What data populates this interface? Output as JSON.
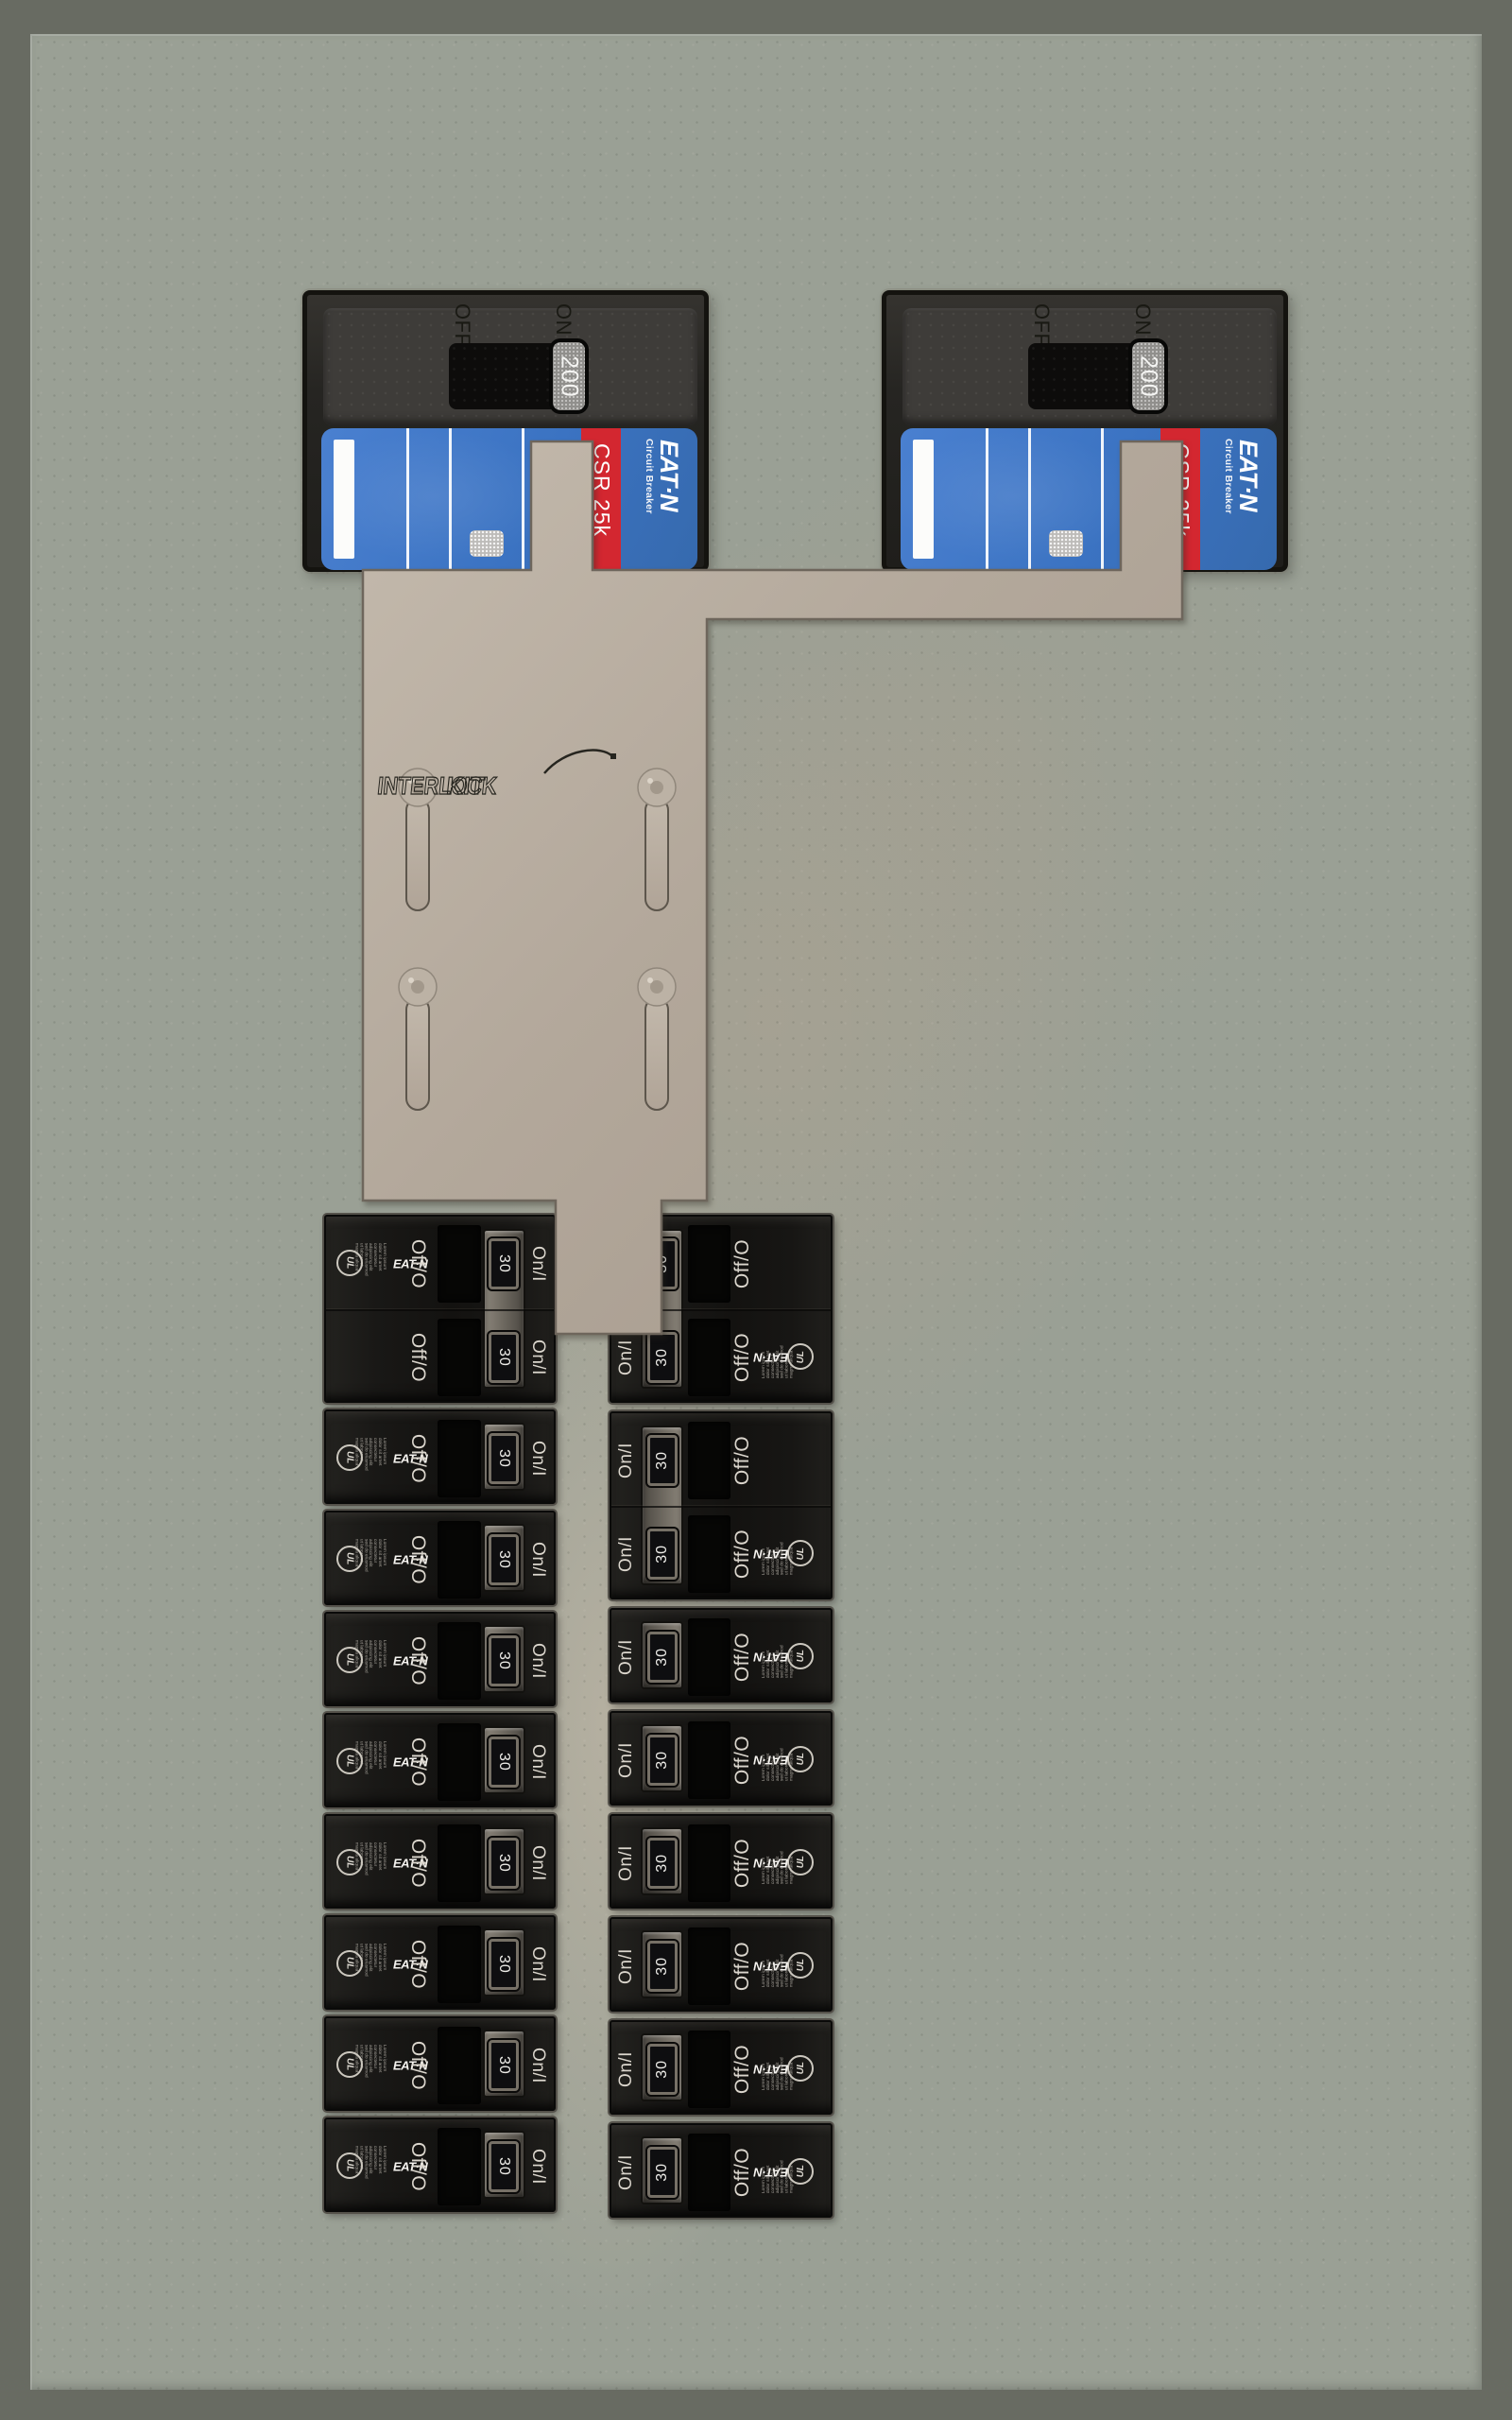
{
  "panel": {
    "description": "Residential load center with generator interlock kit",
    "colors": {
      "frame": "#686b62",
      "backplate": "#9aa095",
      "plate_tan": "#b2a79a",
      "breaker_blue": "#3d76c6",
      "breaker_red": "#d32730",
      "breaker_body": "#161513"
    }
  },
  "main_breakers": {
    "off_label": "OFF",
    "on_label": "ON",
    "handle_label": "200",
    "model_label": "CSR 25k",
    "brand_label": "EAT·N",
    "brand_sub_label": "Circuit Breaker",
    "units": [
      {
        "id": "main-left",
        "state": "ON"
      },
      {
        "id": "main-right",
        "state": "ON"
      }
    ]
  },
  "interlock_plate": {
    "logo_text": "INTERLOCK",
    "logo_suffix": "KIT"
  },
  "branch_breakers": {
    "off_label": "Off/O",
    "on_label": "On/I",
    "amp_label": "30",
    "brand_label": "EAT·N",
    "ul_label": "UL",
    "fine_print_lines": [
      "Lorem ipsum",
      "dolor sit amet",
      "consectetur",
      "adipiscing elit",
      "sed do eiusmod",
      "ut labore et",
      "magna aliqua"
    ],
    "columns": [
      {
        "id": "left",
        "orientation": "left",
        "blocks": [
          {
            "poles": 2
          },
          {
            "poles": 1
          },
          {
            "poles": 1
          },
          {
            "poles": 1
          },
          {
            "poles": 1
          },
          {
            "poles": 1
          },
          {
            "poles": 1
          },
          {
            "poles": 1
          },
          {
            "poles": 1
          }
        ]
      },
      {
        "id": "right",
        "orientation": "right",
        "blocks": [
          {
            "poles": 2
          },
          {
            "poles": 2
          },
          {
            "poles": 1
          },
          {
            "poles": 1
          },
          {
            "poles": 1
          },
          {
            "poles": 1
          },
          {
            "poles": 1
          },
          {
            "poles": 1
          }
        ]
      }
    ]
  }
}
